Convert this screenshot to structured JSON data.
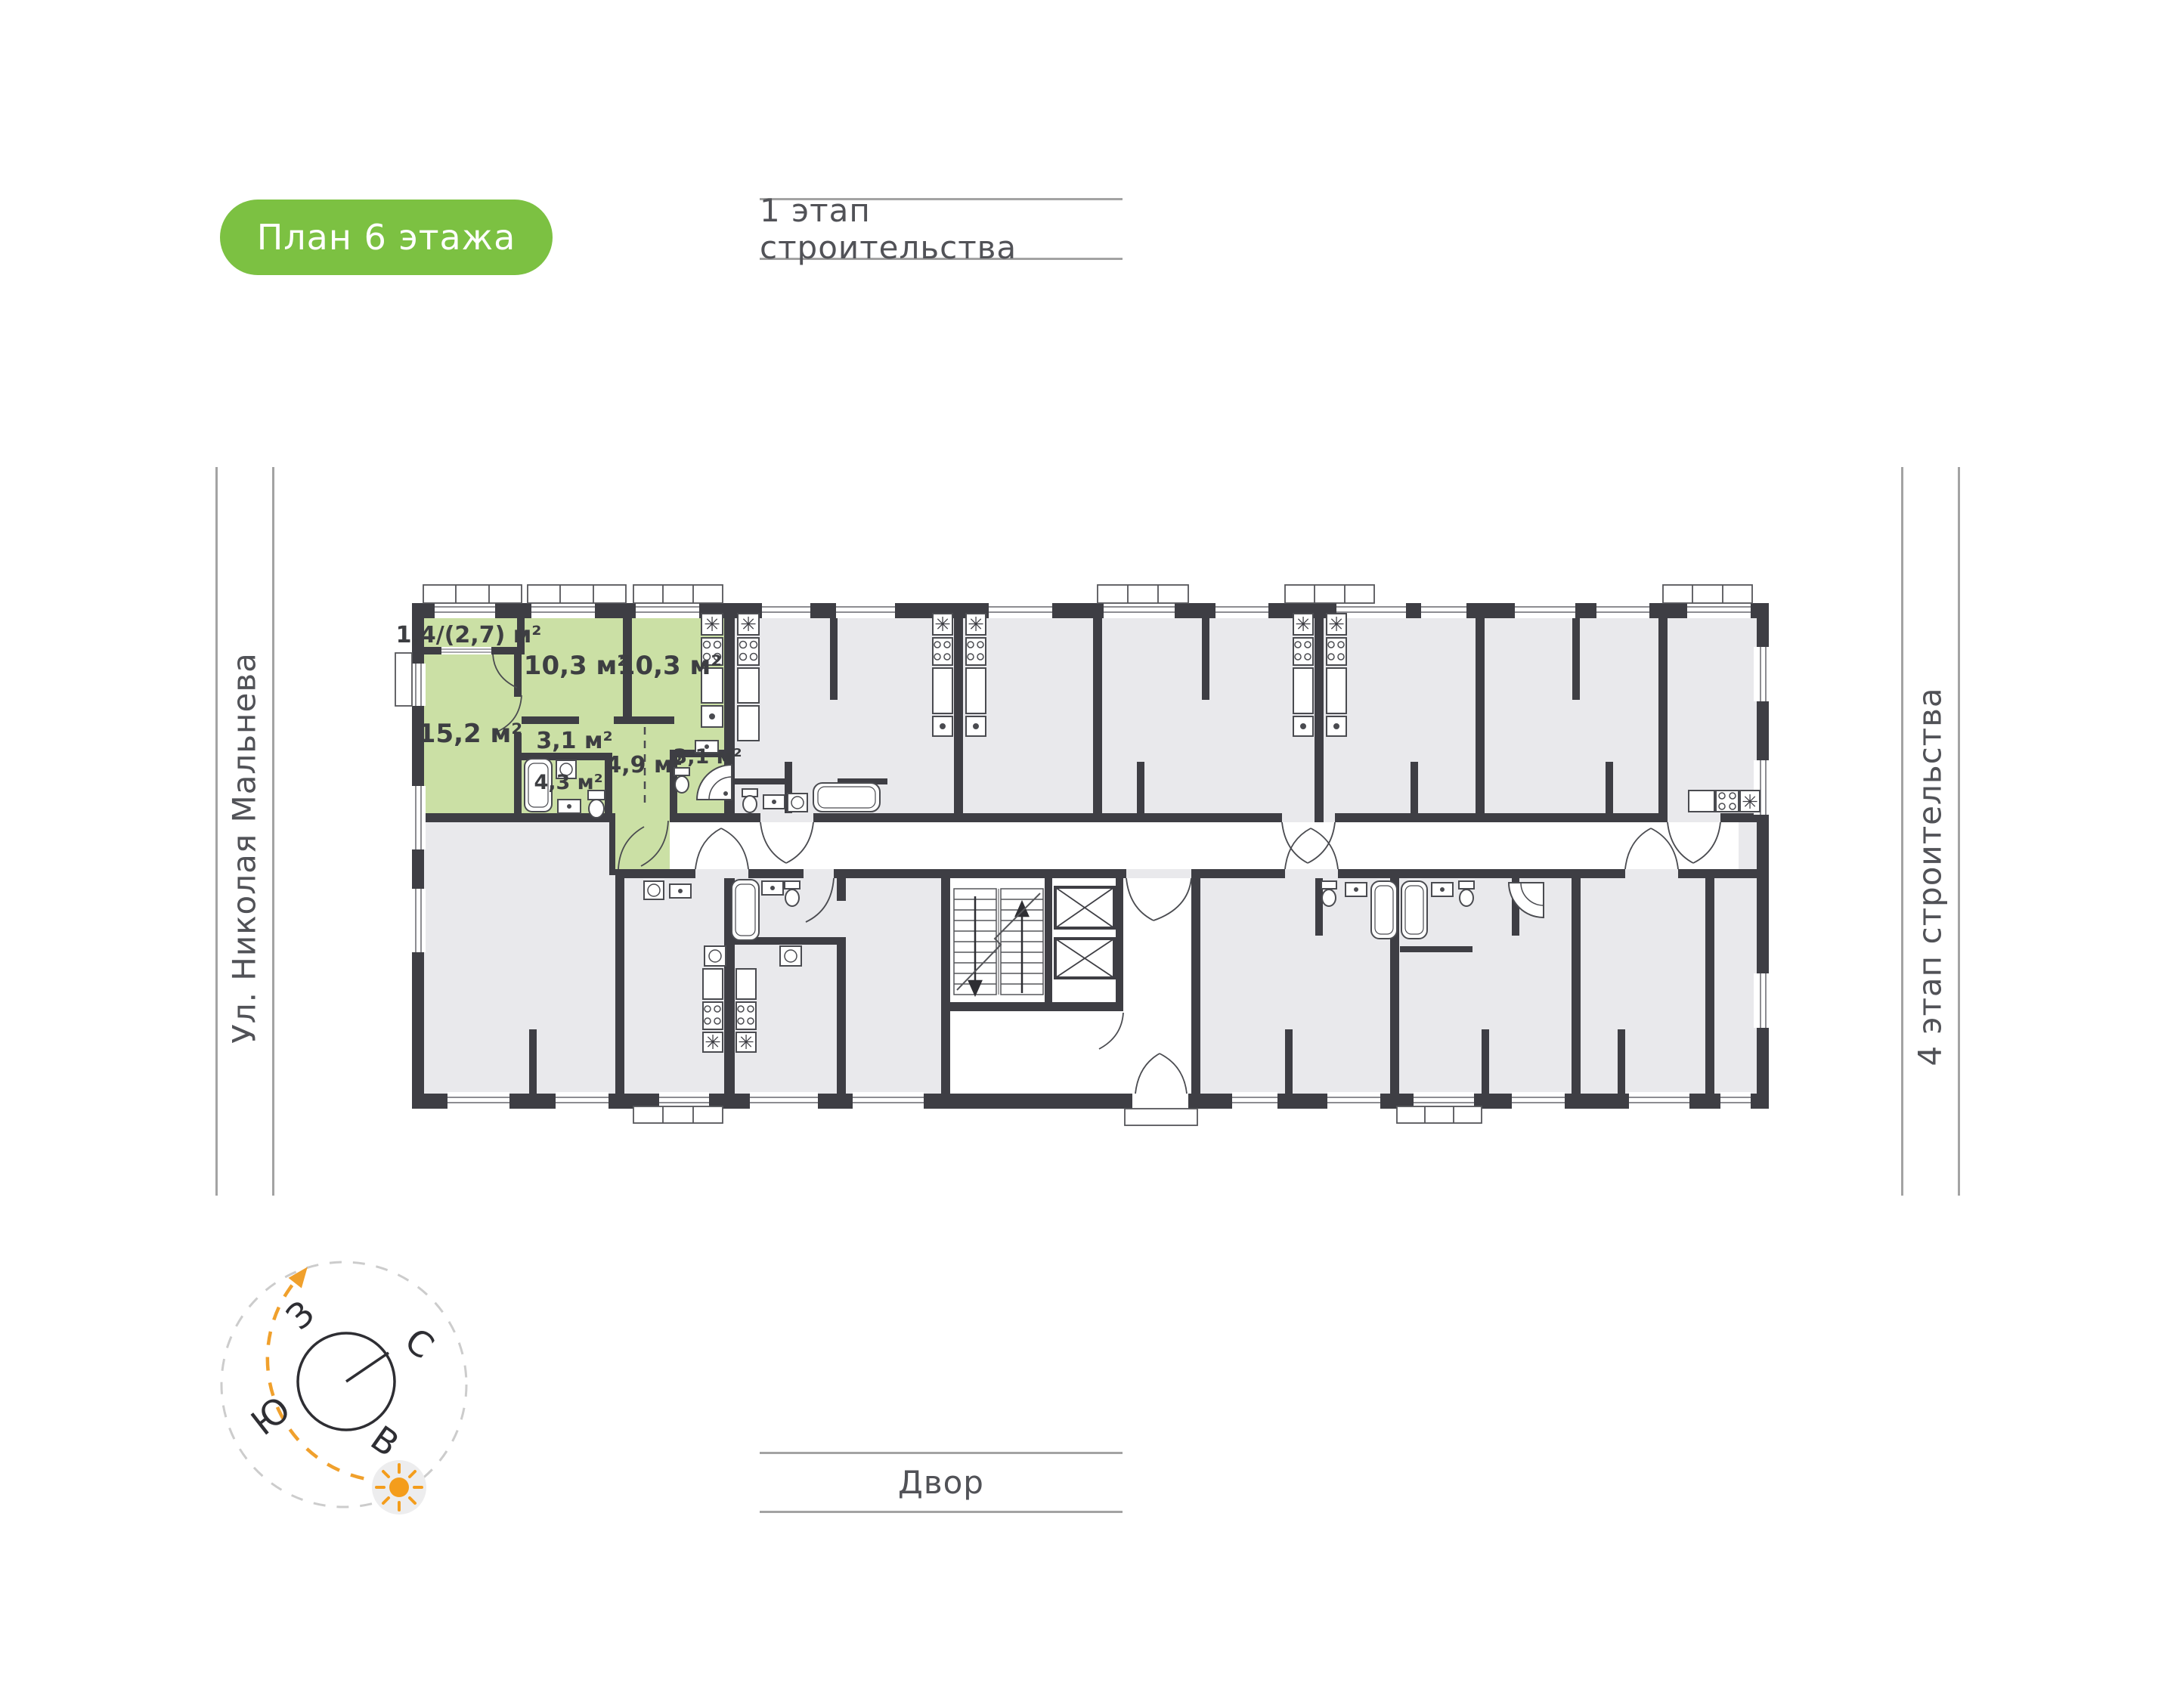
{
  "badge": {
    "label": "План 6 этажа",
    "bg": "#7cc142"
  },
  "top_label": {
    "text": "1 этап строительства"
  },
  "left_label": {
    "text": "Ул. Николая Мальнева"
  },
  "right_label": {
    "text": "4 этап строительства"
  },
  "bottom_label": {
    "text": "Двор"
  },
  "compass": {
    "west": "З",
    "north": "С",
    "south": "Ю",
    "east": "В",
    "accent_orange": "#f49d1c"
  },
  "floorplan": {
    "highlight_color": "#cbe0a5",
    "wall_color": "#3e3e44",
    "room_fill": "#e9e9ec",
    "rooms": [
      {
        "id": "balcony",
        "area": "1,4/(2,7) м²"
      },
      {
        "id": "bedroom",
        "area": "10,3 м²"
      },
      {
        "id": "kitchen",
        "area": "10,3 м²"
      },
      {
        "id": "living-room",
        "area": "15,2 м²"
      },
      {
        "id": "hallway",
        "area": "3,1 м²"
      },
      {
        "id": "corridor",
        "area": "4,9 м²"
      },
      {
        "id": "bathroom",
        "area": "3,1 м²"
      },
      {
        "id": "bathroom-2",
        "area": "4,3 м²"
      }
    ]
  }
}
